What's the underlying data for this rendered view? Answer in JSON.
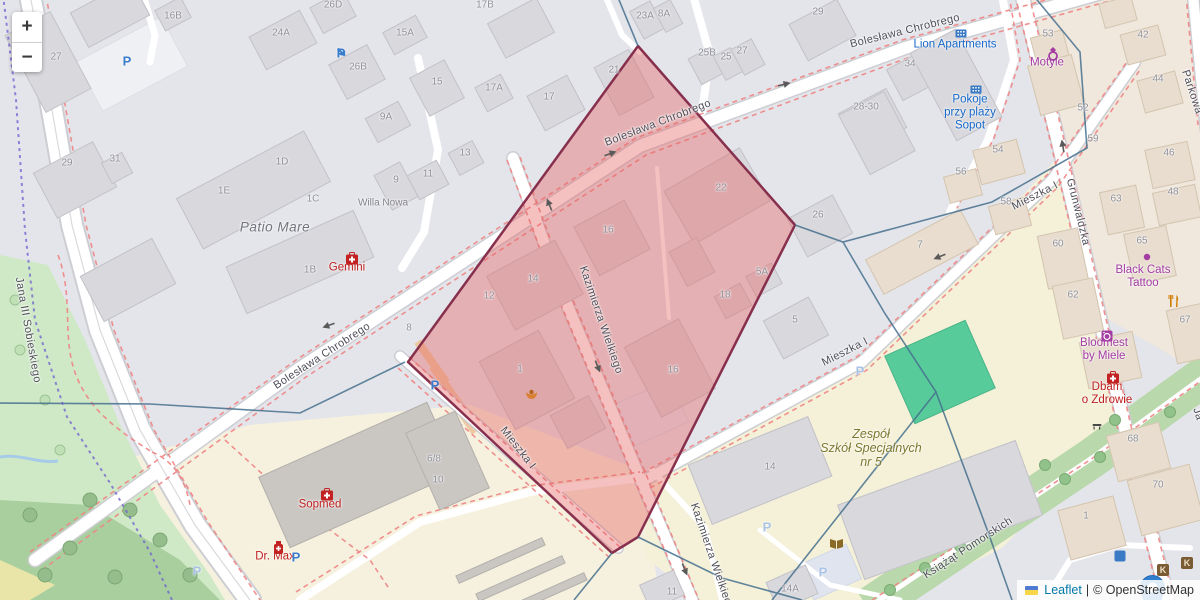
{
  "app": {
    "title": "Leaflet map with highlighted area"
  },
  "controls": {
    "zoom_in": "+",
    "zoom_out": "−"
  },
  "attribution": {
    "leaflet_link": "Leaflet",
    "separator": "|",
    "osm_text": "© OpenStreetMap"
  },
  "colors": {
    "highlight_fill": "rgba(231,98,98,0.40)",
    "highlight_stroke": "#87304e",
    "admin_boundary": "#47708e",
    "admin_boundary_dashed": "#6f5fd0",
    "route_dash": "#ef8585",
    "water": "#a6cbe8",
    "pitch": "#58cb9b",
    "marker_blue": "#2f7fd1",
    "poi_blue": "#1668c9",
    "poi_purple": "#a33ca3",
    "poi_red": "#bf1f1f",
    "school_olive": "#7d7830"
  },
  "highlight_polygon": {
    "points": [
      [
        638,
        46
      ],
      [
        795,
        225
      ],
      [
        638,
        537
      ],
      [
        612,
        553
      ],
      [
        408,
        362
      ]
    ]
  },
  "marker": {
    "x": 1140,
    "y": 575
  },
  "streets": [
    {
      "t": "Bolesława Chrobrego",
      "x": 905,
      "y": 31,
      "rot": -14
    },
    {
      "t": "Bolesława Chrobrego",
      "x": 658,
      "y": 123,
      "rot": -21
    },
    {
      "t": "Bolesława Chrobrego",
      "x": 322,
      "y": 356,
      "rot": -33
    },
    {
      "t": "Kazimierza Wielkiego",
      "x": 601,
      "y": 320,
      "rot": 71
    },
    {
      "t": "Kazimierza Wielkiego",
      "x": 712,
      "y": 557,
      "rot": 71
    },
    {
      "t": "Mieszka I",
      "x": 845,
      "y": 352,
      "rot": -27
    },
    {
      "t": "Mieszka I",
      "x": 1035,
      "y": 196,
      "rot": -27
    },
    {
      "t": "Mieszka I",
      "x": 518,
      "y": 448,
      "rot": 52
    },
    {
      "t": "Grunwaldzka",
      "x": 1078,
      "y": 212,
      "rot": 76
    },
    {
      "t": "Jana III Sobieskiego",
      "x": 28,
      "y": 330,
      "rot": 80
    },
    {
      "t": "Parkowa",
      "x": 1192,
      "y": 92,
      "rot": 72
    },
    {
      "t": "Ja",
      "x": 1198,
      "y": 414,
      "rot": 72
    },
    {
      "t": "Książąt Pomorskich",
      "x": 968,
      "y": 548,
      "rot": -33
    }
  ],
  "place_labels": [
    {
      "lines": [
        "Lion Apartments"
      ],
      "x": 955,
      "y": 45,
      "cls": "blue"
    },
    {
      "lines": [
        "Pokoje",
        "przy plaży",
        "Sopot"
      ],
      "x": 970,
      "y": 113,
      "cls": "blue"
    },
    {
      "lines": [
        "Motyle"
      ],
      "x": 1047,
      "y": 63,
      "cls": "purple"
    },
    {
      "lines": [
        "Black Cats",
        "Tattoo"
      ],
      "x": 1143,
      "y": 277,
      "cls": "purple"
    },
    {
      "lines": [
        "Bloomest",
        "by Miele"
      ],
      "x": 1104,
      "y": 350,
      "cls": "purple"
    },
    {
      "lines": [
        "Gemini"
      ],
      "x": 347,
      "y": 268,
      "cls": "red"
    },
    {
      "lines": [
        "Sopmed"
      ],
      "x": 320,
      "y": 505,
      "cls": "red"
    },
    {
      "lines": [
        "Dr. Max"
      ],
      "x": 275,
      "y": 557,
      "cls": "red"
    },
    {
      "lines": [
        "Dbam",
        "o Zdrowie"
      ],
      "x": 1107,
      "y": 394,
      "cls": "red"
    },
    {
      "lines": [
        "Zespół",
        "Szkół Specjalnych",
        "nr 5"
      ],
      "x": 871,
      "y": 448,
      "cls": "olive"
    },
    {
      "lines": [
        "Patio Mare"
      ],
      "x": 275,
      "y": 227,
      "cls": "gray-it"
    },
    {
      "lines": [
        "Willa Nowa"
      ],
      "x": 383,
      "y": 203,
      "cls": "gray-sm"
    }
  ],
  "house_numbers": [
    {
      "t": "16B",
      "x": 173,
      "y": 16
    },
    {
      "t": "27",
      "x": 56,
      "y": 57
    },
    {
      "t": "24A",
      "x": 281,
      "y": 33
    },
    {
      "t": "26D",
      "x": 333,
      "y": 5
    },
    {
      "t": "26B",
      "x": 358,
      "y": 67
    },
    {
      "t": "15A",
      "x": 405,
      "y": 33
    },
    {
      "t": "15",
      "x": 437,
      "y": 82
    },
    {
      "t": "9A",
      "x": 386,
      "y": 117
    },
    {
      "t": "17B",
      "x": 485,
      "y": 5
    },
    {
      "t": "17A",
      "x": 494,
      "y": 88
    },
    {
      "t": "17",
      "x": 549,
      "y": 97
    },
    {
      "t": "21",
      "x": 614,
      "y": 70
    },
    {
      "t": "23A",
      "x": 645,
      "y": 16
    },
    {
      "t": "8A",
      "x": 664,
      "y": 14
    },
    {
      "t": "25B",
      "x": 707,
      "y": 53
    },
    {
      "t": "25",
      "x": 726,
      "y": 57
    },
    {
      "t": "27",
      "x": 742,
      "y": 51
    },
    {
      "t": "29",
      "x": 818,
      "y": 12
    },
    {
      "t": "34",
      "x": 910,
      "y": 64
    },
    {
      "t": "28-30",
      "x": 866,
      "y": 107
    },
    {
      "t": "53",
      "x": 1048,
      "y": 34
    },
    {
      "t": "42",
      "x": 1143,
      "y": 35
    },
    {
      "t": "44",
      "x": 1158,
      "y": 79
    },
    {
      "t": "52",
      "x": 1083,
      "y": 108
    },
    {
      "t": "59",
      "x": 1093,
      "y": 139
    },
    {
      "t": "29",
      "x": 67,
      "y": 163
    },
    {
      "t": "31",
      "x": 115,
      "y": 159
    },
    {
      "t": "1D",
      "x": 282,
      "y": 162
    },
    {
      "t": "1E",
      "x": 224,
      "y": 191
    },
    {
      "t": "1C",
      "x": 313,
      "y": 199
    },
    {
      "t": "1B",
      "x": 310,
      "y": 270
    },
    {
      "t": "9",
      "x": 396,
      "y": 180
    },
    {
      "t": "11",
      "x": 428,
      "y": 174
    },
    {
      "t": "13",
      "x": 465,
      "y": 153
    },
    {
      "t": "8",
      "x": 409,
      "y": 328
    },
    {
      "t": "14",
      "x": 533,
      "y": 279
    },
    {
      "t": "12",
      "x": 489,
      "y": 296
    },
    {
      "t": "16",
      "x": 608,
      "y": 230
    },
    {
      "t": "22",
      "x": 721,
      "y": 188
    },
    {
      "t": "5A",
      "x": 762,
      "y": 272
    },
    {
      "t": "18",
      "x": 725,
      "y": 295
    },
    {
      "t": "1",
      "x": 520,
      "y": 369
    },
    {
      "t": "16",
      "x": 673,
      "y": 370
    },
    {
      "t": "5",
      "x": 795,
      "y": 320
    },
    {
      "t": "26",
      "x": 818,
      "y": 215
    },
    {
      "t": "7",
      "x": 920,
      "y": 245
    },
    {
      "t": "54",
      "x": 998,
      "y": 150
    },
    {
      "t": "56",
      "x": 961,
      "y": 172
    },
    {
      "t": "58",
      "x": 1006,
      "y": 202
    },
    {
      "t": "46",
      "x": 1169,
      "y": 153
    },
    {
      "t": "48",
      "x": 1173,
      "y": 192
    },
    {
      "t": "63",
      "x": 1116,
      "y": 199
    },
    {
      "t": "65",
      "x": 1142,
      "y": 241
    },
    {
      "t": "60",
      "x": 1058,
      "y": 244
    },
    {
      "t": "62",
      "x": 1073,
      "y": 295
    },
    {
      "t": "67",
      "x": 1185,
      "y": 320
    },
    {
      "t": "68",
      "x": 1133,
      "y": 439
    },
    {
      "t": "70",
      "x": 1158,
      "y": 485
    },
    {
      "t": "1",
      "x": 1086,
      "y": 516
    },
    {
      "t": "6/8",
      "x": 434,
      "y": 459
    },
    {
      "t": "10",
      "x": 438,
      "y": 480
    },
    {
      "t": "14",
      "x": 770,
      "y": 467
    },
    {
      "t": "14A",
      "x": 790,
      "y": 589
    },
    {
      "t": "11",
      "x": 672,
      "y": 592
    }
  ],
  "icons": [
    {
      "kind": "parking",
      "x": 127,
      "y": 61,
      "v": "strong"
    },
    {
      "kind": "parking",
      "x": 296,
      "y": 557,
      "v": "strong"
    },
    {
      "kind": "parking",
      "x": 435,
      "y": 385,
      "v": "strong"
    },
    {
      "kind": "parking",
      "x": 197,
      "y": 571,
      "v": "pale"
    },
    {
      "kind": "parking",
      "x": 860,
      "y": 371,
      "v": "pale"
    },
    {
      "kind": "parking",
      "x": 767,
      "y": 527,
      "v": "pale"
    },
    {
      "kind": "parking",
      "x": 823,
      "y": 572,
      "v": "pale"
    },
    {
      "kind": "parking-entrance",
      "x": 341,
      "y": 53
    },
    {
      "kind": "pharmacy",
      "x": 345,
      "y": 252
    },
    {
      "kind": "pharmacy",
      "x": 320,
      "y": 488
    },
    {
      "kind": "pharmacy",
      "x": 1106,
      "y": 371
    },
    {
      "kind": "pharmacy-bottle",
      "x": 273,
      "y": 541
    },
    {
      "kind": "ring",
      "x": 1047,
      "y": 47
    },
    {
      "kind": "tattoo-dot",
      "x": 1143,
      "y": 253
    },
    {
      "kind": "laundry",
      "x": 1101,
      "y": 330
    },
    {
      "kind": "restaurant",
      "x": 1168,
      "y": 295
    },
    {
      "kind": "book",
      "x": 829,
      "y": 538
    },
    {
      "kind": "apartments",
      "x": 955,
      "y": 29
    },
    {
      "kind": "apartments",
      "x": 970,
      "y": 85
    },
    {
      "kind": "poi-orange",
      "x": 525,
      "y": 388
    },
    {
      "kind": "bench",
      "x": 1092,
      "y": 422
    },
    {
      "kind": "shop-brown",
      "x": 1163,
      "y": 570
    },
    {
      "kind": "shop-brown",
      "x": 1187,
      "y": 563
    },
    {
      "kind": "blue-chip",
      "x": 1120,
      "y": 556
    },
    {
      "kind": "oneway-arrow",
      "x": 603,
      "y": 152,
      "rot": -20
    },
    {
      "kind": "oneway-arrow",
      "x": 777,
      "y": 82,
      "rot": -14
    },
    {
      "kind": "oneway-arrow",
      "x": 548,
      "y": 212,
      "rot": -112
    },
    {
      "kind": "oneway-arrow",
      "x": 599,
      "y": 359,
      "rot": 68
    },
    {
      "kind": "oneway-arrow",
      "x": 686,
      "y": 562,
      "rot": 68
    },
    {
      "kind": "oneway-arrow",
      "x": 336,
      "y": 327,
      "rot": 160
    },
    {
      "kind": "oneway-arrow",
      "x": 947,
      "y": 258,
      "rot": 158
    },
    {
      "kind": "oneway-arrow",
      "x": 1060,
      "y": 153,
      "rot": -100
    }
  ]
}
